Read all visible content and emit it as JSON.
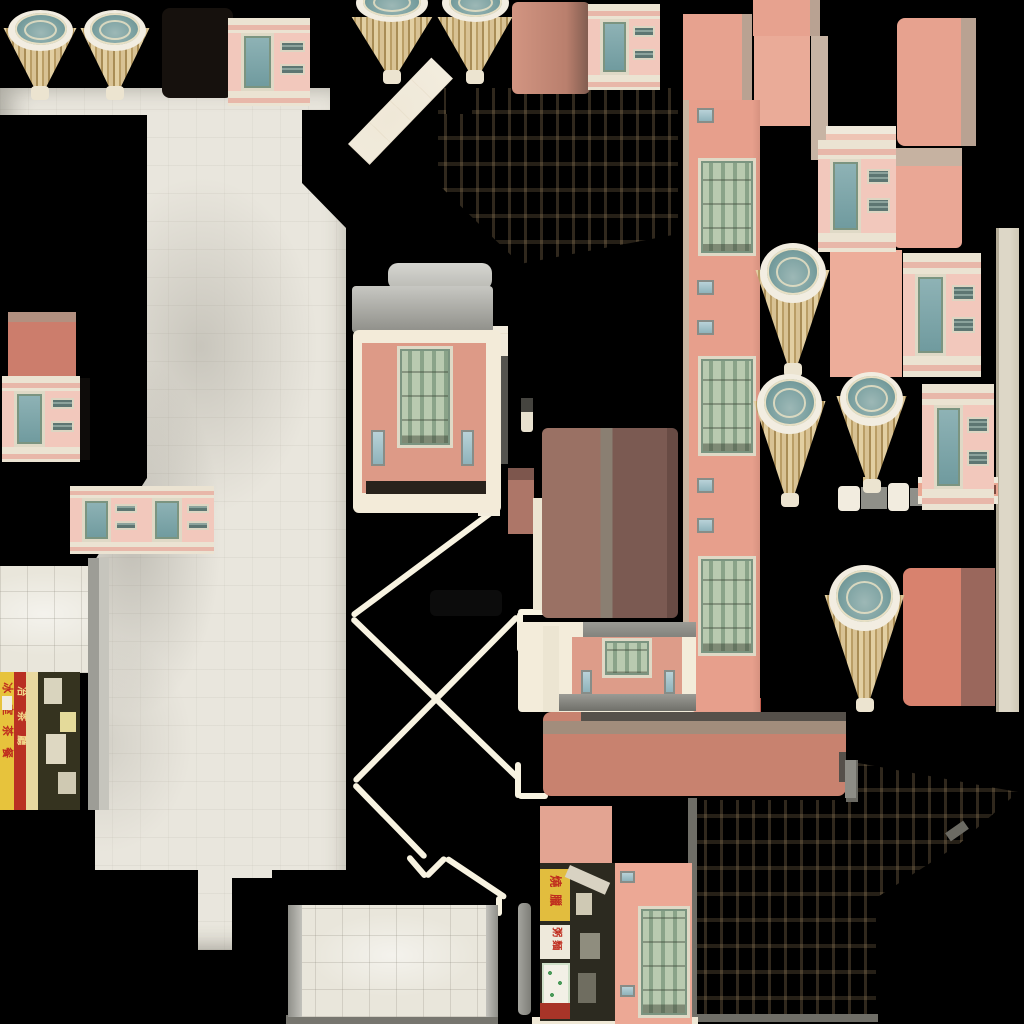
{
  "atlas": {
    "description": "building facade texture atlas on black background",
    "colors": {
      "bg": "#000000",
      "salmon": "#e7a28f",
      "salmon_light": "#edad9a",
      "tan_strip": "#b9a292",
      "cream": "#f2ecdf",
      "marble": "#e9e6dd",
      "marble_bright": "#f4efe2",
      "dome_teal": "#7aa0a0",
      "fan_gold": "#d8c294",
      "window_green": "#9db297",
      "glass_teal": "#7fa8ab",
      "brown_dark": "#7b5a52",
      "xline_cream": "#f8f3e1",
      "sign_yellow": "#e7c33c",
      "sign_red": "#b93023"
    },
    "cones": [
      {
        "x": 2,
        "y": 10,
        "w": 76,
        "h": 90,
        "cut": 0
      },
      {
        "x": 79,
        "y": 10,
        "w": 72,
        "h": 90,
        "cut": 0
      },
      {
        "x": 350,
        "y": 0,
        "w": 84,
        "h": 84,
        "cut": 1
      },
      {
        "x": 436,
        "y": 0,
        "w": 78,
        "h": 84,
        "cut": 1
      },
      {
        "x": 754,
        "y": 243,
        "w": 77,
        "h": 134,
        "cut": 0
      },
      {
        "x": 752,
        "y": 374,
        "w": 75,
        "h": 133,
        "cut": 0
      },
      {
        "x": 835,
        "y": 372,
        "w": 73,
        "h": 121,
        "cut": 0
      },
      {
        "x": 823,
        "y": 565,
        "w": 83,
        "h": 147,
        "cut": 0
      }
    ],
    "rects": [
      {
        "n": "dark-awning-block",
        "x": 162,
        "y": 8,
        "w": 71,
        "h": 90,
        "bg": "#16110d",
        "r": 8
      },
      {
        "n": "salmon-block",
        "x": 683,
        "y": 14,
        "w": 69,
        "h": 92,
        "bg": "#e7a28f",
        "layers": [
          {
            "x": 59,
            "y": 0,
            "w": 10,
            "h": 92,
            "bg": "#b9a292"
          }
        ]
      },
      {
        "n": "salmon-block",
        "x": 753,
        "y": 0,
        "w": 67,
        "h": 36,
        "bg": "#e7a28f",
        "layers": [
          {
            "x": 57,
            "y": 0,
            "w": 10,
            "h": 36,
            "bg": "#b9a292"
          }
        ]
      },
      {
        "n": "salmon-block",
        "x": 754,
        "y": 36,
        "w": 56,
        "h": 90,
        "bg": "#eaab98"
      },
      {
        "n": "tan-strip",
        "x": 811,
        "y": 36,
        "w": 17,
        "h": 124,
        "bg": "#c7b4a4"
      },
      {
        "n": "salmon-block",
        "x": 897,
        "y": 18,
        "w": 79,
        "h": 128,
        "bg": "#e7a28f",
        "r": 8,
        "layers": [
          {
            "x": 64,
            "y": 0,
            "w": 15,
            "h": 128,
            "bg": "#b9a292"
          }
        ]
      },
      {
        "n": "cornice-piece",
        "x": 826,
        "y": 126,
        "w": 70,
        "h": 26,
        "bg": "#efe9db",
        "layers": [
          {
            "x": 0,
            "y": 8,
            "w": 70,
            "h": 11,
            "bg": "#eec4b4"
          }
        ]
      },
      {
        "n": "salmon-block",
        "x": 894,
        "y": 148,
        "w": 68,
        "h": 100,
        "bg": "#eaa795",
        "r": 6,
        "layers": [
          {
            "x": 0,
            "y": 0,
            "w": 68,
            "h": 18,
            "bg": "#c6b2a1"
          }
        ]
      },
      {
        "n": "salmon-block",
        "x": 830,
        "y": 250,
        "w": 72,
        "h": 127,
        "bg": "#edad9a"
      },
      {
        "n": "salmon-block-dark-edge",
        "x": 903,
        "y": 568,
        "w": 92,
        "h": 138,
        "bg": "#d8826e",
        "r": 8,
        "layers": [
          {
            "x": 58,
            "y": 0,
            "w": 34,
            "h": 138,
            "bg": "#9a675c"
          }
        ]
      },
      {
        "n": "salmon-block",
        "x": 8,
        "y": 312,
        "w": 68,
        "h": 64,
        "bg": "#cc7d6c",
        "layers": [
          {
            "x": 0,
            "y": 0,
            "w": 68,
            "h": 10,
            "bg": "#b29080"
          }
        ]
      },
      {
        "n": "salmon-block",
        "x": 540,
        "y": 806,
        "w": 72,
        "h": 60,
        "bg": "#e3a492"
      },
      {
        "n": "shaded-salmon-block",
        "x": 512,
        "y": 2,
        "w": 78,
        "h": 92,
        "r": 6,
        "bg": "linear-gradient(90deg,#d29582,#b97f6d 70%,#7d5a4e)"
      },
      {
        "n": "dark-brown-door-block",
        "x": 542,
        "y": 428,
        "w": 136,
        "h": 190,
        "r": 6,
        "bg": "linear-gradient(90deg,#9a7164 0 43%,#8a7f72 43% 52%,#7b5a52 52% 92%,#684b44 92% 100%)"
      },
      {
        "n": "small-brown-block",
        "x": 508,
        "y": 468,
        "w": 26,
        "h": 66,
        "bg": "#ad7668",
        "layers": [
          {
            "x": 0,
            "y": 0,
            "w": 26,
            "h": 12,
            "bg": "#7d564d"
          }
        ]
      },
      {
        "n": "small-pole",
        "x": 521,
        "y": 398,
        "w": 12,
        "h": 34,
        "bg": "#e8e1cf",
        "r": 3,
        "layers": [
          {
            "x": 0,
            "y": 0,
            "w": 12,
            "h": 14,
            "bg": "#45443f"
          }
        ]
      },
      {
        "n": "cream-strip",
        "x": 533,
        "y": 498,
        "w": 9,
        "h": 112,
        "bg": "#ece5d2"
      },
      {
        "n": "long-salmon-strip",
        "x": 543,
        "y": 712,
        "w": 303,
        "h": 84,
        "r": 8,
        "bg": "#c8826f",
        "layers": [
          {
            "x": 38,
            "y": 0,
            "w": 265,
            "h": 9,
            "bg": "#55504a"
          },
          {
            "x": 0,
            "y": 9,
            "w": 303,
            "h": 13,
            "bg": "#a28d7c"
          },
          {
            "x": 296,
            "y": 40,
            "w": 7,
            "h": 30,
            "bg": "#55504a"
          }
        ]
      },
      {
        "n": "grey-tab",
        "x": 845,
        "y": 760,
        "w": 11,
        "h": 38,
        "bg": "#8d8d86"
      },
      {
        "n": "red-bar",
        "x": 685,
        "y": 698,
        "w": 76,
        "h": 14,
        "bg": "#c05a4b"
      },
      {
        "n": "grey-strip",
        "x": 88,
        "y": 558,
        "w": 11,
        "h": 252,
        "bg": "#9d9d96"
      },
      {
        "n": "grey-strip",
        "x": 99,
        "y": 558,
        "w": 10,
        "h": 252,
        "bg": "#c6c5bd"
      },
      {
        "n": "right-edge-tan-strip",
        "x": 996,
        "y": 228,
        "w": 23,
        "h": 484,
        "bg": "linear-gradient(90deg,#b3ab97 0 3px,#ddd7c7 3px 60%,#cfc8b6)"
      },
      {
        "n": "knob-piece",
        "x": 838,
        "y": 486,
        "w": 22,
        "h": 25,
        "bg": "#f2ecdf",
        "r": 4
      },
      {
        "n": "knob-piece",
        "x": 861,
        "y": 487,
        "w": 26,
        "h": 22,
        "bg": "#8f8f88"
      },
      {
        "n": "knob-piece",
        "x": 888,
        "y": 483,
        "w": 21,
        "h": 28,
        "bg": "#f2ecdf",
        "r": 4
      },
      {
        "n": "knob-piece",
        "x": 910,
        "y": 488,
        "w": 19,
        "h": 18,
        "bg": "#90908a"
      },
      {
        "n": "gold-bit",
        "x": 863,
        "y": 477,
        "w": 13,
        "h": 10,
        "bg": "#d3bc86"
      },
      {
        "n": "cornice-piece",
        "x": 918,
        "y": 477,
        "w": 80,
        "h": 27,
        "bg": "#efe9da",
        "layers": [
          {
            "x": 0,
            "y": 6,
            "w": 80,
            "h": 13,
            "bg": "#eaa893"
          },
          {
            "x": 70,
            "y": 8,
            "w": 8,
            "h": 9,
            "bg": "#7c4a40"
          }
        ]
      },
      {
        "n": "faint-dark-rect",
        "x": 430,
        "y": 590,
        "w": 72,
        "h": 26,
        "bg": "#0c0c0c",
        "r": 6
      },
      {
        "n": "black-sliver",
        "x": 78,
        "y": 378,
        "w": 12,
        "h": 82,
        "bg": "#0e0c0a"
      },
      {
        "n": "cream-border",
        "x": 611,
        "y": 864,
        "w": 6,
        "h": 158,
        "bg": "#efe8d6"
      },
      {
        "n": "cream-bottom-strip",
        "x": 532,
        "y": 1017,
        "w": 166,
        "h": 7,
        "bg": "#efe8d6"
      },
      {
        "n": "awning-bar",
        "x": 388,
        "y": 263,
        "w": 104,
        "h": 27,
        "r": 10,
        "bg": "linear-gradient(#d6d6d1,#b9b9b3)"
      },
      {
        "n": "awning-bar",
        "x": 352,
        "y": 286,
        "w": 141,
        "h": 47,
        "r": 4,
        "bg": "linear-gradient(#c7c7c2,#8e8e88)"
      },
      {
        "n": "white-strip",
        "x": 478,
        "y": 420,
        "w": 22,
        "h": 96,
        "bg": "#f2ecdc"
      },
      {
        "n": "grey-strip",
        "x": 499,
        "y": 356,
        "w": 9,
        "h": 108,
        "bg": "#55544f"
      },
      {
        "n": "tile-bottom-bar",
        "x": 286,
        "y": 1015,
        "w": 212,
        "h": 9,
        "bg": "#77766f"
      },
      {
        "n": "grey-pole",
        "x": 518,
        "y": 903,
        "w": 13,
        "h": 112,
        "r": 5,
        "bg": "linear-gradient(90deg,#a4a49e,#7e7e78)"
      }
    ],
    "pink_facades": [
      {
        "x": 228,
        "y": 18,
        "w": 82,
        "h": 88
      },
      {
        "x": 2,
        "y": 376,
        "w": 78,
        "h": 86
      },
      {
        "x": 70,
        "y": 486,
        "w": 72,
        "h": 68
      },
      {
        "x": 140,
        "y": 486,
        "w": 74,
        "h": 68
      },
      {
        "x": 588,
        "y": 4,
        "w": 72,
        "h": 86
      },
      {
        "x": 818,
        "y": 140,
        "w": 78,
        "h": 112
      },
      {
        "x": 903,
        "y": 253,
        "w": 78,
        "h": 124
      },
      {
        "x": 922,
        "y": 384,
        "w": 72,
        "h": 126
      }
    ],
    "tall_strip": {
      "x": 683,
      "y": 100,
      "w": 77,
      "h": 612,
      "windows": [
        {
          "y": 58,
          "h": 98
        },
        {
          "y": 256,
          "h": 100
        },
        {
          "y": 456,
          "h": 100
        }
      ],
      "small_windows": [
        {
          "y": 8
        },
        {
          "y": 180
        },
        {
          "y": 220
        },
        {
          "y": 378
        },
        {
          "y": 418
        }
      ]
    },
    "center_facade": {
      "frame": {
        "x": 353,
        "y": 330,
        "w": 148,
        "h": 183
      },
      "salmon": {
        "x": 362,
        "y": 343,
        "w": 124,
        "h": 150
      },
      "window": {
        "x": 397,
        "y": 346,
        "w": 56,
        "h": 102
      },
      "small_windows": [
        {
          "x": 371,
          "y": 430,
          "w": 14,
          "h": 36
        },
        {
          "x": 461,
          "y": 430,
          "w": 13,
          "h": 36
        }
      ],
      "dark_band": {
        "x": 366,
        "y": 481,
        "w": 120,
        "h": 13
      }
    },
    "small_facade": {
      "frame": {
        "x": 518,
        "y": 622,
        "w": 178,
        "h": 90
      },
      "top_bar": {
        "x": 583,
        "y": 622,
        "w": 113,
        "h": 15
      },
      "salmon": {
        "x": 572,
        "y": 637,
        "w": 110,
        "h": 60
      },
      "window": {
        "x": 602,
        "y": 638,
        "w": 50,
        "h": 40
      },
      "small_windows": [
        {
          "x": 581,
          "y": 670,
          "w": 11,
          "h": 24
        },
        {
          "x": 664,
          "y": 670,
          "w": 11,
          "h": 24
        }
      ],
      "bottom_bar": {
        "x": 558,
        "y": 694,
        "w": 138,
        "h": 17
      },
      "cream_strip": {
        "x": 543,
        "y": 626,
        "w": 16,
        "h": 86
      }
    },
    "facade_w": {
      "box": {
        "x": 615,
        "y": 863,
        "w": 77,
        "h": 161
      },
      "window": {
        "x": 23,
        "y": 43,
        "w": 52,
        "h": 112
      },
      "small_windows": [
        {
          "x": 5,
          "y": 8,
          "w": 15,
          "h": 12
        },
        {
          "x": 5,
          "y": 122,
          "w": 15,
          "h": 12
        }
      ]
    },
    "marble_left": {
      "x": 0,
      "y": 88,
      "w": 346,
      "h": 862,
      "poly": "0 0,330 0,330 22,302 22,302 95,346 140,346 782,272 782,272 790,232 790,232 862,198 862,198 782,95 782,95 472,147 390,147 27,0 27"
    },
    "marble_top_center": {
      "x": 348,
      "y": 84,
      "w": 332,
      "h": 182,
      "poly": "90 4,330 4,330 150,172 180,90 100",
      "band": {
        "x": 0,
        "y": 60,
        "w": 120,
        "h": 30,
        "rot": -46
      },
      "notch": {
        "x": 98,
        "y": 2,
        "w": 26,
        "h": 28
      }
    },
    "marble_bottom_right": {
      "x": 688,
      "y": 760,
      "w": 332,
      "h": 262,
      "poly": "2 40,160 40,160 3,170 3,330 32,270 85,188 138,188 258,2 258",
      "edges": [
        {
          "x": 0,
          "y": 38,
          "w": 9,
          "h": 220,
          "bg": "#6f6e67"
        },
        {
          "x": 158,
          "y": 0,
          "w": 12,
          "h": 42,
          "bg": "#6b6a63"
        },
        {
          "x": 0,
          "y": 254,
          "w": 190,
          "h": 8,
          "bg": "#6f6e67"
        }
      ],
      "notch": {
        "x": 258,
        "y": 66,
        "w": 22,
        "h": 10,
        "rot": -35,
        "bg": "#6b6a63"
      }
    },
    "marble_mid_bit": {
      "x": 486,
      "y": 326,
      "w": 22,
      "h": 98
    },
    "white_tile_block": {
      "x": 0,
      "y": 566,
      "w": 88,
      "h": 107
    },
    "tile_block_bottom": {
      "box": {
        "x": 288,
        "y": 905,
        "w": 210,
        "h": 112
      },
      "left_border": {
        "w": 14
      },
      "right_border": {
        "w": 12
      }
    },
    "xlines": [
      {
        "x1": 352,
        "y1": 616,
        "x2": 500,
        "y2": 506
      },
      {
        "x1": 352,
        "y1": 618,
        "x2": 520,
        "y2": 780
      },
      {
        "x1": 518,
        "y1": 616,
        "x2": 354,
        "y2": 782
      },
      {
        "x1": 354,
        "y1": 784,
        "x2": 426,
        "y2": 858
      },
      {
        "x1": 408,
        "y1": 856,
        "x2": 426,
        "y2": 877
      },
      {
        "x1": 426,
        "y1": 877,
        "x2": 446,
        "y2": 857
      },
      {
        "x1": 446,
        "y1": 858,
        "x2": 506,
        "y2": 898
      },
      {
        "x1": 499,
        "y1": 896,
        "x2": 499,
        "y2": 916
      },
      {
        "x1": 518,
        "y1": 612,
        "x2": 547,
        "y2": 612
      },
      {
        "x1": 520,
        "y1": 612,
        "x2": 520,
        "y2": 652
      },
      {
        "x1": 518,
        "y1": 762,
        "x2": 518,
        "y2": 798
      },
      {
        "x1": 518,
        "y1": 796,
        "x2": 548,
        "y2": 796
      }
    ],
    "storefront_left": {
      "box": {
        "x": 0,
        "y": 672,
        "w": 80,
        "h": 138
      },
      "yellow_col_glyphs": [
        "冰",
        "室",
        "茶",
        "餐"
      ],
      "red_col_glyphs": [
        "冶",
        "茶",
        "廳"
      ],
      "stickers": [
        {
          "x": 44,
          "y": 6,
          "w": 18,
          "h": 26,
          "bg": "#d9d4be"
        },
        {
          "x": 60,
          "y": 40,
          "w": 16,
          "h": 20,
          "bg": "#e4da9a"
        },
        {
          "x": 46,
          "y": 62,
          "w": 20,
          "h": 30,
          "bg": "#ded8c2"
        },
        {
          "x": 58,
          "y": 100,
          "w": 18,
          "h": 22,
          "bg": "#cfc9b2"
        }
      ]
    },
    "storefront_bottom": {
      "box": {
        "x": 540,
        "y": 863,
        "w": 75,
        "h": 158
      },
      "yellow_sign_glyphs": [
        "燒",
        "臘"
      ],
      "white_sign_glyphs": [
        "粥",
        "麵"
      ],
      "stickers": [
        {
          "x": 36,
          "y": 30,
          "w": 16,
          "h": 22,
          "bg": "#cfc9b4"
        },
        {
          "x": 40,
          "y": 70,
          "w": 20,
          "h": 26,
          "bg": "#8f8d7e"
        },
        {
          "x": 38,
          "y": 110,
          "w": 18,
          "h": 30,
          "bg": "#6f6d60"
        }
      ]
    }
  }
}
